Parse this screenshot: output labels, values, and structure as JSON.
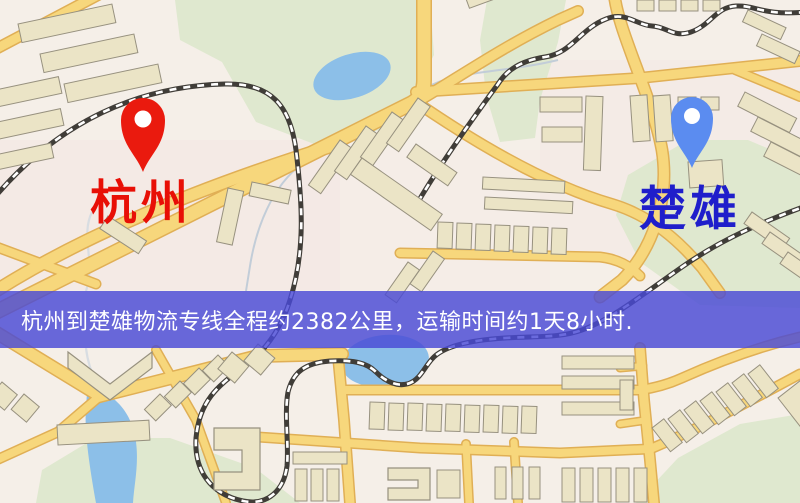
{
  "map": {
    "origin": {
      "label": "杭州"
    },
    "destination": {
      "label": "楚雄"
    },
    "banner": {
      "text": "杭州到楚雄物流专线全程约2382公里，运输时间约1天8小时."
    }
  },
  "colors": {
    "background": "#f5efe8",
    "origin_label": "#e80f06",
    "origin_marker": "#ea1a0e",
    "destination_label": "#1f1ecb",
    "destination_marker": "#5b8cf0",
    "marker_inner": "#ffffff",
    "banner_bg": "rgba(73,73,213,0.82)",
    "banner_text": "#ffffff",
    "road_fill": "#f7d77c",
    "road_casing": "#e0af55",
    "water": "#8cbfe8",
    "park": "#dfe8cf",
    "building_fill": "#ebe4c6",
    "building_stroke": "#97917f",
    "railway": "#403d38"
  }
}
